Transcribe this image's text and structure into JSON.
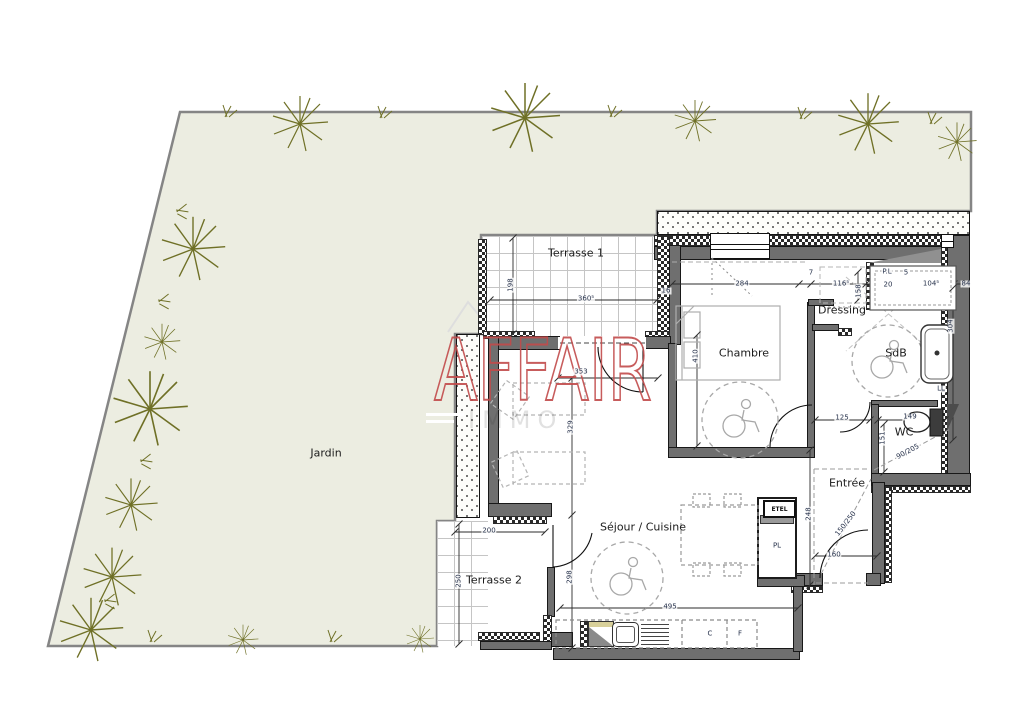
{
  "watermark": {
    "brand": "AFFAIR",
    "brand_sub": "IMMO",
    "brand_color": "#c24b4b"
  },
  "rooms": {
    "jardin": {
      "label": "Jardin"
    },
    "terrasse1": {
      "label": "Terrasse 1"
    },
    "terrasse2": {
      "label": "Terrasse 2"
    },
    "chambre": {
      "label": "Chambre"
    },
    "dressing": {
      "label": "Dressing"
    },
    "sdb": {
      "label": "SdB"
    },
    "wc": {
      "label": "WC"
    },
    "entree": {
      "label": "Entrée"
    },
    "sejour": {
      "label": "Séjour / Cuisine"
    }
  },
  "fixtures": {
    "etel": "ETEL"
  },
  "annotations": [
    {
      "t": "198",
      "x": 511,
      "y": 285,
      "r": -90
    },
    {
      "t": "360⁵",
      "x": 586,
      "y": 299
    },
    {
      "t": "16",
      "x": 666,
      "y": 291
    },
    {
      "t": "353",
      "x": 581,
      "y": 372
    },
    {
      "t": "329",
      "x": 571,
      "y": 427,
      "r": -90
    },
    {
      "t": "298",
      "x": 570,
      "y": 577,
      "r": -90
    },
    {
      "t": "200",
      "x": 489,
      "y": 531
    },
    {
      "t": "250",
      "x": 459,
      "y": 581,
      "r": -90
    },
    {
      "t": "495",
      "x": 670,
      "y": 607
    },
    {
      "t": "284",
      "x": 742,
      "y": 284
    },
    {
      "t": "7",
      "x": 811,
      "y": 273
    },
    {
      "t": "116⁵",
      "x": 841,
      "y": 284
    },
    {
      "t": "158",
      "x": 859,
      "y": 291,
      "r": -90
    },
    {
      "t": "P.L",
      "x": 887,
      "y": 272
    },
    {
      "t": "5",
      "x": 906,
      "y": 273
    },
    {
      "t": "20",
      "x": 888,
      "y": 285
    },
    {
      "t": "104⁵",
      "x": 931,
      "y": 284
    },
    {
      "t": "84",
      "x": 966,
      "y": 284
    },
    {
      "t": "410",
      "x": 696,
      "y": 356,
      "r": -90
    },
    {
      "t": "304",
      "x": 951,
      "y": 326,
      "r": -90
    },
    {
      "t": "125",
      "x": 842,
      "y": 418
    },
    {
      "t": "149",
      "x": 910,
      "y": 417
    },
    {
      "t": "151",
      "x": 883,
      "y": 438,
      "r": -90
    },
    {
      "t": "LL",
      "x": 941,
      "y": 389
    },
    {
      "t": "248",
      "x": 809,
      "y": 514,
      "r": -90
    },
    {
      "t": "160",
      "x": 834,
      "y": 555
    },
    {
      "t": "150/250",
      "x": 846,
      "y": 524,
      "r": -52
    },
    {
      "t": "90/205",
      "x": 908,
      "y": 452,
      "r": -28
    },
    {
      "t": "C",
      "x": 710,
      "y": 634
    },
    {
      "t": "F",
      "x": 740,
      "y": 634
    },
    {
      "t": "PL",
      "x": 777,
      "y": 546
    }
  ],
  "colors": {
    "garden_fill": "#ecede1",
    "garden_border": "#858585",
    "wall_gray": "#6f6f6f",
    "plant_olive": "#6f7026",
    "dimension_text": "#25304a"
  }
}
